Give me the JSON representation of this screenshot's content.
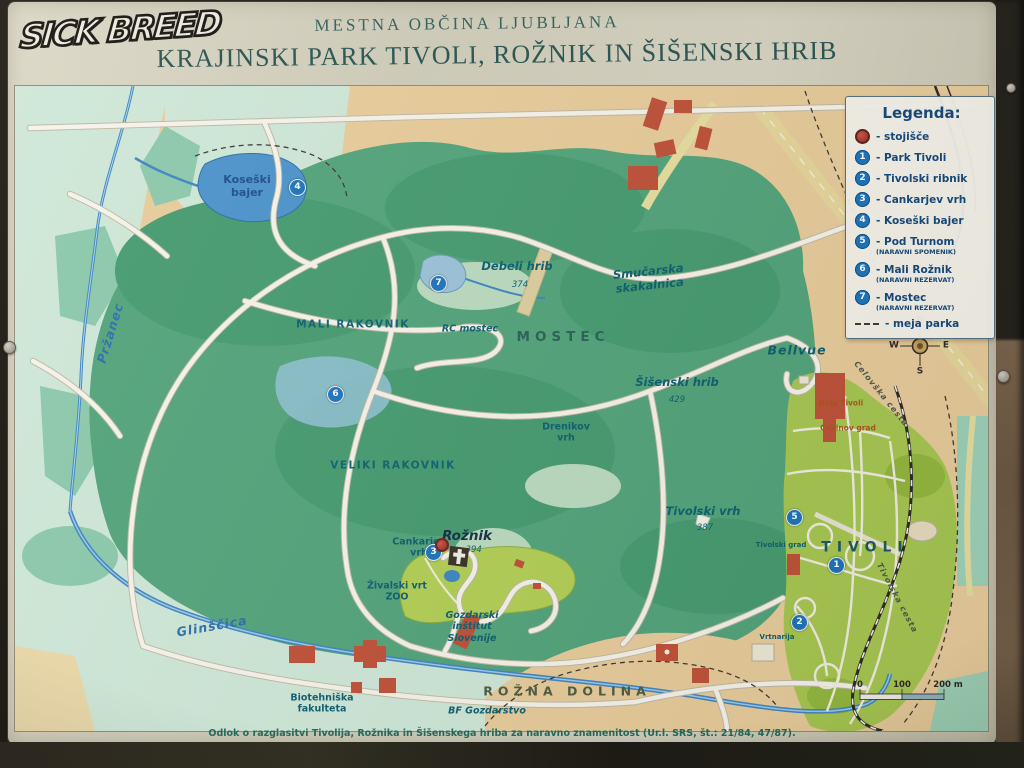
{
  "sign": {
    "graffiti": "SICK BREED",
    "municipality": "MESTNA OBČINA LJUBLJANA",
    "title": "KRAJINSKI PARK TIVOLI, ROŽNIK IN ŠIŠENSKI HRIB",
    "footnote": "Odlok o razglasitvi Tivolija, Rožnika in Šišenskega hriba za naravno znamenitost (Ur.l. SRS, št.: 21/84, 47/87)."
  },
  "legend": {
    "title": "Legenda:",
    "items": [
      {
        "symbol": "stojisce",
        "label": "- stojišče"
      },
      {
        "symbol": "1",
        "label": "- Park Tivoli"
      },
      {
        "symbol": "2",
        "label": "- Tivolski ribnik"
      },
      {
        "symbol": "3",
        "label": "- Cankarjev vrh"
      },
      {
        "symbol": "4",
        "label": "- Koseški bajer"
      },
      {
        "symbol": "5",
        "label": "- Pod Turnom",
        "sub": "(NARAVNI SPOMENIK)"
      },
      {
        "symbol": "6",
        "label": "- Mali Rožnik",
        "sub": "(NARAVNI REZERVAT)"
      },
      {
        "symbol": "7",
        "label": "- Mostec",
        "sub": "(NARAVNI REZERVAT)"
      },
      {
        "symbol": "dash",
        "label": "- meja parka"
      }
    ]
  },
  "map": {
    "labels": [
      {
        "id": "lbl-koseski-bajer",
        "t": "Koseški\nbajer",
        "x": 232,
        "y": 100,
        "cls": "water"
      },
      {
        "id": "lbl-przanec",
        "t": "Pržanec",
        "x": 95,
        "y": 247,
        "cls": "stream",
        "rot": -73
      },
      {
        "id": "lbl-debeli-hrib",
        "t": "Debeli hrib",
        "x": 502,
        "y": 181,
        "cls": "hill"
      },
      {
        "id": "lbl-debeli-hrib-elev",
        "t": "374",
        "x": 505,
        "y": 199,
        "cls": "elev"
      },
      {
        "id": "lbl-smucarska-skakalnica",
        "t": "Smučarska\nskakalnica",
        "x": 634,
        "y": 193,
        "cls": "hill",
        "rot": -6
      },
      {
        "id": "lbl-rc-mostec",
        "t": "RC mostec",
        "x": 455,
        "y": 243,
        "cls": "itsm"
      },
      {
        "id": "lbl-mostec",
        "t": "MOSTEC",
        "x": 548,
        "y": 251,
        "cls": "spread"
      },
      {
        "id": "lbl-mali-rakovnik",
        "t": "MALI RAKOVNIK",
        "x": 338,
        "y": 239,
        "cls": "caps"
      },
      {
        "id": "lbl-veliki-rakovnik",
        "t": "VELIKI RAKOVNIK",
        "x": 378,
        "y": 380,
        "cls": "caps"
      },
      {
        "id": "lbl-sisenski-hrib",
        "t": "Šišenski hrib",
        "x": 662,
        "y": 297,
        "cls": "hill"
      },
      {
        "id": "lbl-sisenski-hrib-elev",
        "t": "429",
        "x": 662,
        "y": 314,
        "cls": "elev"
      },
      {
        "id": "lbl-drenikov-vrh",
        "t": "Drenikov\nvrh",
        "x": 551,
        "y": 347,
        "cls": "small"
      },
      {
        "id": "lbl-bellvue",
        "t": "Bellvue",
        "x": 782,
        "y": 264,
        "cls": "bellvue"
      },
      {
        "id": "lbl-hala-tivoli",
        "t": "Hala Tivoli",
        "x": 826,
        "y": 317,
        "cls": "orange"
      },
      {
        "id": "lbl-cekinov-grad",
        "t": "Cekinov grad",
        "x": 833,
        "y": 342,
        "cls": "orange"
      },
      {
        "id": "lbl-celovska-cesta",
        "t": "Celovška cesta",
        "x": 866,
        "y": 308,
        "cls": "roadlbl",
        "rot": 51
      },
      {
        "id": "lbl-tivolski-vrh",
        "t": "Tivolski vrh",
        "x": 688,
        "y": 426,
        "cls": "hill"
      },
      {
        "id": "lbl-tivolski-vrh-elev",
        "t": "387",
        "x": 690,
        "y": 442,
        "cls": "elev"
      },
      {
        "id": "lbl-tivolski-grad",
        "t": "Tivolski grad",
        "x": 766,
        "y": 459,
        "cls": "tiny"
      },
      {
        "id": "lbl-tivoli",
        "t": "TIVOLI",
        "x": 850,
        "y": 462,
        "cls": "tivoli"
      },
      {
        "id": "lbl-vrtnarija",
        "t": "Vrtnarija",
        "x": 762,
        "y": 551,
        "cls": "tiny"
      },
      {
        "id": "lbl-tivolska-cesta",
        "t": "Tivolska cesta",
        "x": 882,
        "y": 512,
        "cls": "roadlbl",
        "rot": 62
      },
      {
        "id": "lbl-cankarjev-vrh",
        "t": "Cankarjev\nvrh",
        "x": 404,
        "y": 462,
        "cls": "small"
      },
      {
        "id": "lbl-roznik",
        "t": "Rožnik",
        "x": 452,
        "y": 450,
        "cls": "place"
      },
      {
        "id": "lbl-roznik-elev",
        "t": "· 394",
        "x": 456,
        "y": 464,
        "cls": "elev"
      },
      {
        "id": "lbl-zivalski-vrt",
        "t": "Živalski vrt\nZOO",
        "x": 382,
        "y": 506,
        "cls": "small"
      },
      {
        "id": "lbl-gozdarski-institut",
        "t": "Gozdarski\ninštitut\nSlovenije",
        "x": 457,
        "y": 541,
        "cls": "itsm"
      },
      {
        "id": "lbl-glinscica",
        "t": "Glinščica",
        "x": 197,
        "y": 540,
        "cls": "stream",
        "rot": -10
      },
      {
        "id": "lbl-biotehniska",
        "t": "Biotehniška\nfakulteta",
        "x": 307,
        "y": 618,
        "cls": "small"
      },
      {
        "id": "lbl-bf-gozdarstvo",
        "t": "BF Gozdarstvo",
        "x": 472,
        "y": 625,
        "cls": "itsm"
      },
      {
        "id": "lbl-rozna-dolina",
        "t": "ROŽNA DOLINA",
        "x": 552,
        "y": 605,
        "cls": "spread olive"
      },
      {
        "id": "compass-n",
        "t": "N",
        "x": 905,
        "y": 234,
        "cls": "compass"
      },
      {
        "id": "compass-w",
        "t": "W",
        "x": 879,
        "y": 260,
        "cls": "compass"
      },
      {
        "id": "compass-e",
        "t": "E",
        "x": 931,
        "y": 260,
        "cls": "compass"
      },
      {
        "id": "compass-s",
        "t": "S",
        "x": 905,
        "y": 286,
        "cls": "compass"
      },
      {
        "id": "scale-0",
        "t": "0",
        "x": 845,
        "y": 599,
        "cls": "scalet"
      },
      {
        "id": "scale-100",
        "t": "100",
        "x": 887,
        "y": 599,
        "cls": "scalet"
      },
      {
        "id": "scale-200",
        "t": "200 m",
        "x": 933,
        "y": 599,
        "cls": "scalet"
      }
    ],
    "markers": [
      {
        "n": "1",
        "x": 822,
        "y": 480
      },
      {
        "n": "2",
        "x": 785,
        "y": 537
      },
      {
        "n": "3",
        "x": 419,
        "y": 467
      },
      {
        "n": "4",
        "x": 283,
        "y": 102
      },
      {
        "n": "5",
        "x": 780,
        "y": 432
      },
      {
        "n": "6",
        "x": 321,
        "y": 309
      },
      {
        "n": "7",
        "x": 424,
        "y": 198
      }
    ]
  },
  "colors": {
    "marker_blue": "#1b75bc",
    "stojisce_red": "#b03a2e",
    "forest_green": "#52a47b",
    "tivoli_green": "#a8c851",
    "water_blue": "#4b93cc",
    "sand": "#e9cd9b",
    "label_teal": "#0d5f70",
    "legend_text": "#14487a"
  }
}
